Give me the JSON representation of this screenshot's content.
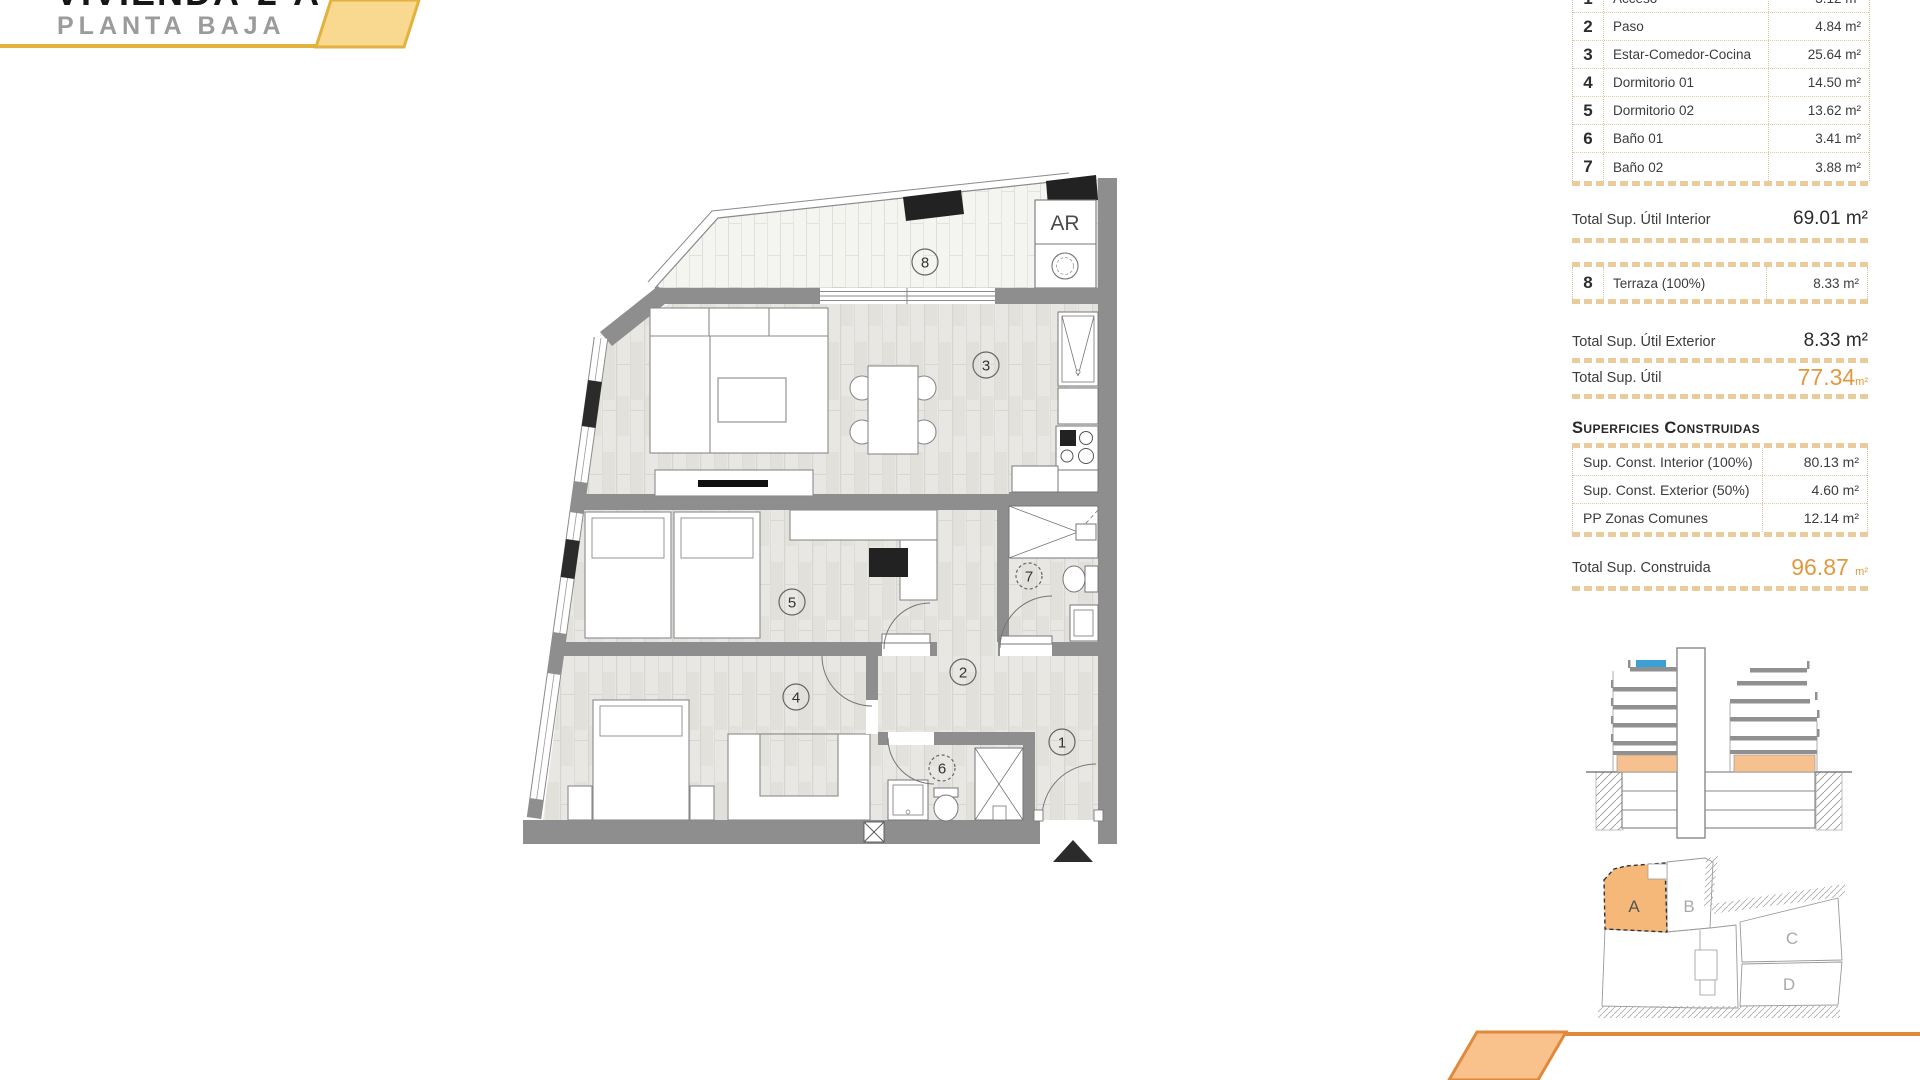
{
  "header": {
    "title_cropped": {
      "word": "VIVIENDA",
      "num": "2",
      "letter": "A"
    },
    "subtitle": "PLANTA BAJA"
  },
  "areas_table": {
    "rows": [
      {
        "num": "1",
        "name": "Acceso",
        "value": "3.12 m²"
      },
      {
        "num": "2",
        "name": "Paso",
        "value": "4.84 m²"
      },
      {
        "num": "3",
        "name": "Estar-Comedor-Cocina",
        "value": "25.64 m²"
      },
      {
        "num": "4",
        "name": "Dormitorio 01",
        "value": "14.50 m²"
      },
      {
        "num": "5",
        "name": "Dormitorio 02",
        "value": "13.62 m²"
      },
      {
        "num": "6",
        "name": "Baño 01",
        "value": "3.41 m²"
      },
      {
        "num": "7",
        "name": "Baño 02",
        "value": "3.88 m²"
      }
    ]
  },
  "totals": {
    "interior_label": "Total Sup. Útil Interior",
    "interior_value": "69.01 m²",
    "terraza": {
      "num": "8",
      "name": "Terraza (100%)",
      "value": "8.33 m²"
    },
    "exterior_label": "Total Sup. Útil Exterior",
    "exterior_value": "8.33 m²",
    "util_label": "Total Sup. Útil",
    "util_value": "77.34",
    "util_unit": "m²"
  },
  "construidas": {
    "heading": "Superficies Construidas",
    "rows": [
      {
        "name": "Sup. Const. Interior (100%)",
        "value": "80.13 m²"
      },
      {
        "name": "Sup. Const. Exterior (50%)",
        "value": "4.60 m²"
      },
      {
        "name": "PP Zonas Comunes",
        "value": "12.14 m²"
      }
    ],
    "total_label": "Total Sup. Construida",
    "total_value": "96.87",
    "total_unit": "m²"
  },
  "floorplan": {
    "rooms": [
      "1",
      "2",
      "3",
      "4",
      "5",
      "6",
      "7",
      "8"
    ],
    "ar_label": "AR"
  },
  "site_plan": {
    "units": [
      "A",
      "B",
      "C",
      "D"
    ],
    "highlighted_unit": "A"
  },
  "colors": {
    "accent_yellow": "#e3b23e",
    "ribbon_yellow_fill": "#f9d88f",
    "accent_orange": "#e0893c",
    "ribbon_orange_fill": "#f9c28c",
    "totals_orange": "#e2983f",
    "wall_gray": "#8e8e8e",
    "site_highlight": "#f5b878",
    "section_ground_floor": "#f6c18e",
    "section_pool_blue": "#3ba0d6"
  }
}
